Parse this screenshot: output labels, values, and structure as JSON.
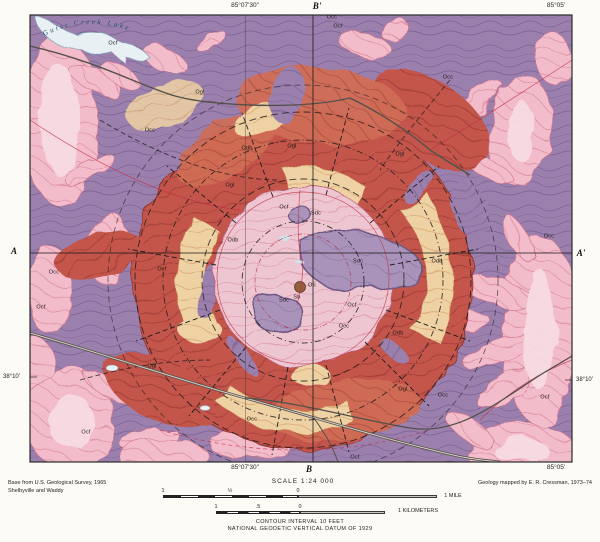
{
  "margin": {
    "top": {
      "lon_w": "85°07'30\"",
      "section_b_prime": "B'",
      "lon_e": "85°05'"
    },
    "bottom": {
      "lon_w": "85°07'30\"",
      "section_b": "B",
      "lon_e": "85°05'"
    },
    "left": {
      "section_a": "A",
      "lat": "38°10'"
    },
    "right": {
      "section_a_prime": "A'",
      "lat": "38°10'"
    },
    "credit_left_line1": "Base from U.S. Geological Survey, 1965",
    "credit_left_line2": "Shelbyville and Waddy",
    "credit_right": "Geology mapped by E. R. Cressman, 1973–74",
    "scale_title": "SCALE 1:24 000",
    "mile_bar": {
      "left_label": "1",
      "half_label": "½",
      "zero_label": "0",
      "right_label": "1 MILE"
    },
    "km_bar": {
      "left_label": "1",
      "half_label": ".5",
      "zero_label": "0",
      "right_label": "1 KILOMETERS"
    },
    "contour_note": "CONTOUR INTERVAL 10 FEET",
    "datum_note": "NATIONAL GEODETIC VERTICAL DATUM OF 1929"
  },
  "map": {
    "lake_name": "Guist Creek Lake",
    "colors": {
      "purple_unit": "#9b80ad",
      "pink_valley": "#f2bcca",
      "brick_red_ring": "#c3554c",
      "orange_ring": "#d06c54",
      "tan_ring": "#efd2a4",
      "inner_pink": "#eec6d1",
      "silurian_gray": "#a993ba",
      "lake_water": "#e9f0f3",
      "fault_black": "#1c1c1c",
      "structure_red": "#c23046",
      "road_gray": "#54504a",
      "center_brown": "#92603c"
    },
    "unit_labels": [
      {
        "t": "Occ",
        "x": 150,
        "y": 131
      },
      {
        "t": "Ogl",
        "x": 200,
        "y": 93
      },
      {
        "t": "Odb",
        "x": 247,
        "y": 149
      },
      {
        "t": "Ogl",
        "x": 292,
        "y": 147
      },
      {
        "t": "Occ",
        "x": 448,
        "y": 78
      },
      {
        "t": "Occ",
        "x": 332,
        "y": 18
      },
      {
        "t": "Ocf",
        "x": 338,
        "y": 27
      },
      {
        "t": "Ocf",
        "x": 113,
        "y": 44
      },
      {
        "t": "Occ",
        "x": 54,
        "y": 273
      },
      {
        "t": "Ocf",
        "x": 41,
        "y": 308
      },
      {
        "t": "Occ",
        "x": 549,
        "y": 237
      },
      {
        "t": "Ocf",
        "x": 284,
        "y": 208
      },
      {
        "t": "Sdc",
        "x": 316,
        "y": 214
      },
      {
        "t": "Sdc",
        "x": 358,
        "y": 262
      },
      {
        "t": "Sdc",
        "x": 284,
        "y": 301
      },
      {
        "t": "Ocf",
        "x": 352,
        "y": 306
      },
      {
        "t": "Occ",
        "x": 344,
        "y": 327
      },
      {
        "t": "Oti",
        "x": 312,
        "y": 286
      },
      {
        "t": "Sb",
        "x": 297,
        "y": 298
      },
      {
        "t": "Ogl",
        "x": 230,
        "y": 186
      },
      {
        "t": "Ocf",
        "x": 162,
        "y": 270
      },
      {
        "t": "Odb",
        "x": 233,
        "y": 241
      },
      {
        "t": "Ogl",
        "x": 152,
        "y": 367
      },
      {
        "t": "Ocf",
        "x": 86,
        "y": 433
      },
      {
        "t": "Odb",
        "x": 398,
        "y": 334
      },
      {
        "t": "Ogl",
        "x": 403,
        "y": 390
      },
      {
        "t": "Occ",
        "x": 443,
        "y": 396
      },
      {
        "t": "Ocf",
        "x": 355,
        "y": 458
      },
      {
        "t": "Ogl",
        "x": 400,
        "y": 155
      },
      {
        "t": "Odb",
        "x": 437,
        "y": 262
      },
      {
        "t": "Ocf",
        "x": 545,
        "y": 398
      },
      {
        "t": "Occ",
        "x": 252,
        "y": 420
      }
    ]
  }
}
